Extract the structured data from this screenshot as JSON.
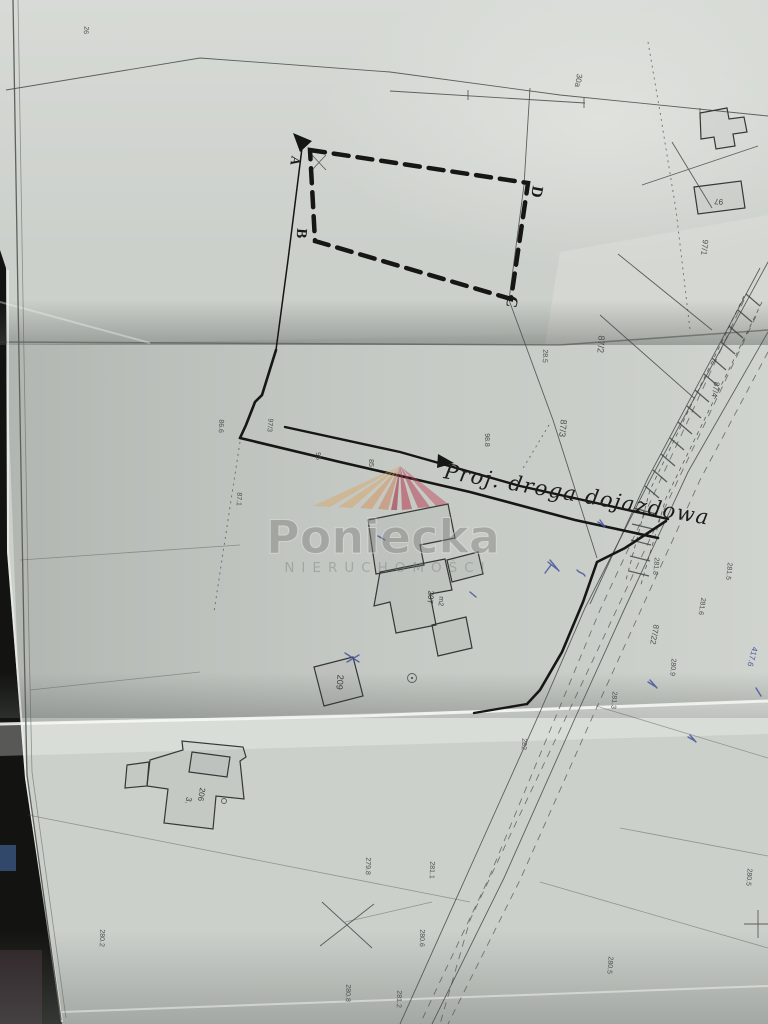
{
  "photo": {
    "description_colors": {
      "paper": "#ccd0cb",
      "ink": "#161715",
      "pen_blue": "#44549a",
      "background_dark": "#101110",
      "ray_tan": "#d9a25e",
      "ray_red": "#b6394e"
    }
  },
  "watermark": {
    "brand": "Poniecka",
    "subtitle": "NIERUCHOMOŚCI"
  },
  "annotations": {
    "road_label": "Proj. droga dojazdowa"
  },
  "map_labels": {
    "corners": [
      {
        "t": "A",
        "x": 291,
        "y": 160,
        "r": 100,
        "s": 13
      },
      {
        "t": "B",
        "x": 297,
        "y": 233,
        "r": 95,
        "s": 15
      },
      {
        "t": "C",
        "x": 507,
        "y": 301,
        "r": 100,
        "s": 16
      },
      {
        "t": "D",
        "x": 532,
        "y": 191,
        "r": 100,
        "s": 16
      }
    ],
    "parcels": [
      {
        "t": "30a",
        "x": 576,
        "y": 80,
        "r": 100,
        "s": 8
      },
      {
        "t": "97/1",
        "x": 702,
        "y": 247,
        "r": 97,
        "s": 8
      },
      {
        "t": "87/2",
        "x": 598,
        "y": 344,
        "r": 94,
        "s": 9
      },
      {
        "t": "87/3",
        "x": 560,
        "y": 428,
        "r": 96,
        "s": 9
      },
      {
        "t": "87/4",
        "x": 713,
        "y": 389,
        "r": 100,
        "s": 8
      },
      {
        "t": "87/22",
        "x": 652,
        "y": 634,
        "r": 100,
        "s": 8
      },
      {
        "t": "97/3",
        "x": 268,
        "y": 425,
        "r": 95,
        "s": 7
      }
    ],
    "elevations": [
      {
        "t": "26",
        "x": 84,
        "y": 30,
        "r": 95,
        "s": 7
      },
      {
        "t": "28.5",
        "x": 543,
        "y": 356,
        "r": 92,
        "s": 7
      },
      {
        "t": "86.6",
        "x": 219,
        "y": 426,
        "r": 93,
        "s": 7
      },
      {
        "t": "87.1",
        "x": 237,
        "y": 499,
        "r": 93,
        "s": 7
      },
      {
        "t": "95",
        "x": 316,
        "y": 456,
        "r": 90,
        "s": 7
      },
      {
        "t": "85",
        "x": 369,
        "y": 463,
        "r": 90,
        "s": 7
      },
      {
        "t": "98.8",
        "x": 485,
        "y": 440,
        "r": 90,
        "s": 7
      },
      {
        "t": "281.8",
        "x": 654,
        "y": 566,
        "r": 96,
        "s": 7
      },
      {
        "t": "281.5",
        "x": 727,
        "y": 571,
        "r": 96,
        "s": 7
      },
      {
        "t": "281.6",
        "x": 700,
        "y": 606,
        "r": 99,
        "s": 7
      },
      {
        "t": "280.9",
        "x": 671,
        "y": 667,
        "r": 95,
        "s": 7
      },
      {
        "t": "281.3",
        "x": 612,
        "y": 700,
        "r": 95,
        "s": 7
      },
      {
        "t": "282",
        "x": 522,
        "y": 744,
        "r": 92,
        "s": 7
      },
      {
        "t": "279.8",
        "x": 366,
        "y": 866,
        "r": 92,
        "s": 7
      },
      {
        "t": "281.1",
        "x": 430,
        "y": 870,
        "r": 92,
        "s": 7
      },
      {
        "t": "280.6",
        "x": 420,
        "y": 938,
        "r": 92,
        "s": 7
      },
      {
        "t": "280.8",
        "x": 346,
        "y": 993,
        "r": 92,
        "s": 7
      },
      {
        "t": "281.2",
        "x": 397,
        "y": 999,
        "r": 92,
        "s": 7
      },
      {
        "t": "280.5",
        "x": 747,
        "y": 877,
        "r": 95,
        "s": 7
      },
      {
        "t": "280.5",
        "x": 608,
        "y": 965,
        "r": 95,
        "s": 7
      },
      {
        "t": "280.2",
        "x": 100,
        "y": 938,
        "r": 92,
        "s": 7
      }
    ],
    "buildings": [
      {
        "t": "207",
        "x": 428,
        "y": 597,
        "r": 95,
        "s": 8
      },
      {
        "t": "m2",
        "x": 439,
        "y": 601,
        "r": 95,
        "s": 7
      },
      {
        "t": "209",
        "x": 337,
        "y": 682,
        "r": 95,
        "s": 9
      },
      {
        "t": "206",
        "x": 199,
        "y": 794,
        "r": 100,
        "s": 8
      },
      {
        "t": "3.",
        "x": 186,
        "y": 800,
        "r": 100,
        "s": 8
      },
      {
        "t": "97",
        "x": 719,
        "y": 199,
        "r": 185,
        "s": 8
      }
    ],
    "blue_notes": [
      {
        "t": "417.6",
        "x": 750,
        "y": 656,
        "r": 105,
        "s": 8
      }
    ]
  }
}
